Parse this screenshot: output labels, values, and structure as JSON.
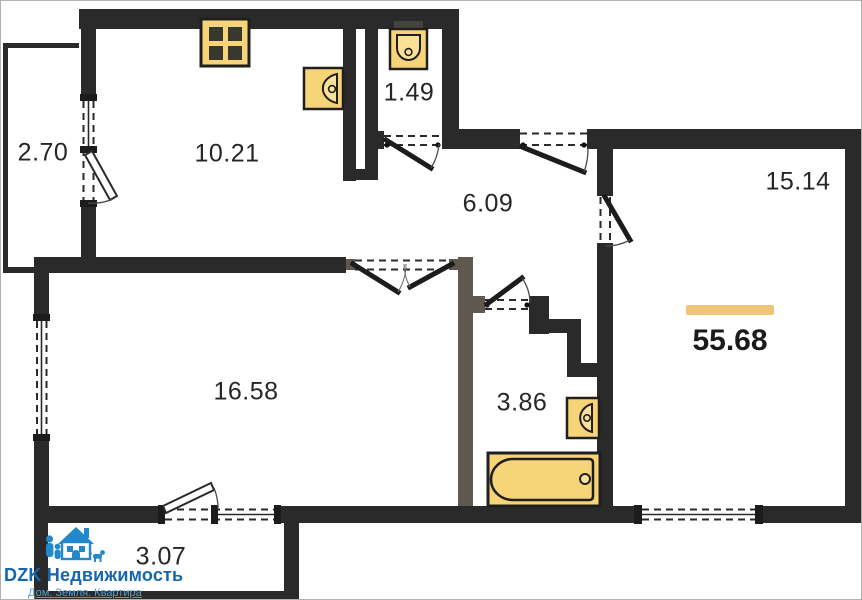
{
  "plan": {
    "total_area_label": "55.68",
    "rooms": [
      {
        "name": "balcony-left",
        "area": "2.70"
      },
      {
        "name": "kitchen",
        "area": "10.21"
      },
      {
        "name": "wc",
        "area": "1.49"
      },
      {
        "name": "hallway",
        "area": "6.09"
      },
      {
        "name": "bedroom",
        "area": "15.14"
      },
      {
        "name": "living-room",
        "area": "16.58"
      },
      {
        "name": "bathroom",
        "area": "3.86"
      },
      {
        "name": "balcony-bottom",
        "area": "3.07"
      }
    ],
    "fixtures": [
      "stove-icon",
      "toilet-icon",
      "kitchen-sink-icon",
      "washbasin-icon",
      "bathtub-icon"
    ],
    "colors": {
      "walls": "#2a2a2a",
      "fixture_fill": "#f8d478",
      "fixture_outline": "#1f1f1f",
      "total_accent_bar": "#eec579",
      "brand_blue": "#1566ac",
      "tagline_blue": "#4f9fd3"
    }
  },
  "logo": {
    "brand": "DZK Недвижимость",
    "tagline": "Дом. Земля. Квартира"
  }
}
